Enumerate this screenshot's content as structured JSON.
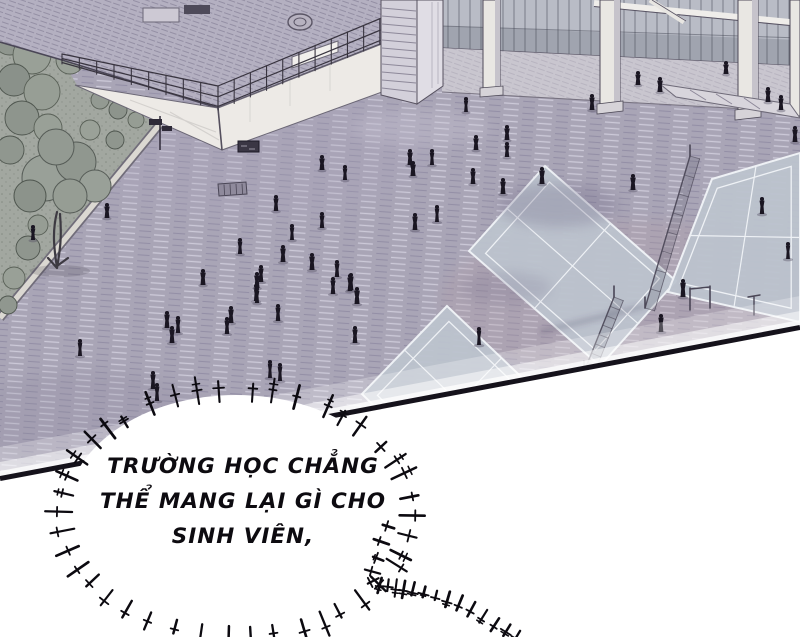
{
  "page": {
    "width": 800,
    "height": 637,
    "background": "#ffffff"
  },
  "panel": {
    "description": "Aerial manga panel: school courtyard with scattered students, badminton courts, glass colonnade, rooftop terrace and garden",
    "border_color": "#15121b"
  },
  "colors": {
    "pavement": "#a9a5b6",
    "court": "#bcc3cd",
    "court_line": "#eef1f5",
    "roof": "#b4b0c1",
    "wall": "#edeae6",
    "garden": "#a2a7a0",
    "foliage": "#959c93",
    "foliage_dark": "#596057",
    "glass": "#b9bcc6",
    "glass_dark": "#8d8f9c",
    "pillar": "#e9e7e3",
    "figure": "#1a1622",
    "figure_shadow": "#565064",
    "net": "#4a4656",
    "bubble_fill": "#ffffff",
    "bubble_stroke": "#0c0a10",
    "text": "#0d0b10"
  },
  "speech_bubble": {
    "lines": [
      "TRƯỜNG HỌC CHẲNG",
      "THỂ MANG LẠI GÌ CHO",
      "SINH VIÊN,"
    ],
    "center_x": 236,
    "center_y": 514,
    "rx": 170,
    "ry": 119
  },
  "scene": {
    "figures": [
      [
        466,
        112,
        15
      ],
      [
        592,
        110,
        16
      ],
      [
        638,
        85,
        14
      ],
      [
        660,
        92,
        15
      ],
      [
        726,
        74,
        13
      ],
      [
        768,
        102,
        15
      ],
      [
        781,
        110,
        15
      ],
      [
        795,
        142,
        16
      ],
      [
        410,
        165,
        16
      ],
      [
        432,
        165,
        16
      ],
      [
        413,
        176,
        15
      ],
      [
        476,
        150,
        15
      ],
      [
        507,
        140,
        15
      ],
      [
        507,
        157,
        15
      ],
      [
        473,
        184,
        16
      ],
      [
        503,
        194,
        16
      ],
      [
        415,
        230,
        17
      ],
      [
        437,
        222,
        17
      ],
      [
        542,
        184,
        17
      ],
      [
        633,
        190,
        16
      ],
      [
        762,
        214,
        17
      ],
      [
        683,
        297,
        18
      ],
      [
        661,
        332,
        18
      ],
      [
        479,
        345,
        18
      ],
      [
        788,
        259,
        17
      ],
      [
        322,
        170,
        15
      ],
      [
        345,
        180,
        15
      ],
      [
        276,
        211,
        16
      ],
      [
        322,
        228,
        16
      ],
      [
        292,
        240,
        16
      ],
      [
        283,
        262,
        17
      ],
      [
        312,
        270,
        17
      ],
      [
        337,
        277,
        17
      ],
      [
        351,
        290,
        17
      ],
      [
        261,
        282,
        17
      ],
      [
        240,
        254,
        16
      ],
      [
        256,
        301,
        17
      ],
      [
        231,
        323,
        17
      ],
      [
        203,
        285,
        16
      ],
      [
        107,
        218,
        15
      ],
      [
        33,
        240,
        15
      ],
      [
        167,
        328,
        17
      ],
      [
        178,
        333,
        17
      ],
      [
        172,
        343,
        17
      ],
      [
        227,
        334,
        17
      ],
      [
        257,
        288,
        16
      ],
      [
        257,
        303,
        16
      ],
      [
        278,
        321,
        17
      ],
      [
        333,
        294,
        17
      ],
      [
        350,
        291,
        17
      ],
      [
        357,
        304,
        17
      ],
      [
        280,
        381,
        18
      ],
      [
        270,
        378,
        18
      ],
      [
        153,
        389,
        18
      ],
      [
        355,
        343,
        17
      ],
      [
        80,
        356,
        17
      ],
      [
        157,
        401,
        18
      ]
    ],
    "courts": [
      {
        "points": [
          [
            545,
            166
          ],
          [
            469,
            251
          ],
          [
            600,
            366
          ],
          [
            676,
            281
          ]
        ]
      },
      {
        "points": [
          [
            712,
            179
          ],
          [
            800,
            153
          ],
          [
            800,
            322
          ],
          [
            668,
            292
          ]
        ]
      },
      {
        "points": [
          [
            447,
            306
          ],
          [
            362,
            394
          ],
          [
            470,
            500
          ],
          [
            556,
            410
          ]
        ]
      }
    ],
    "nets": [
      {
        "x1": 690,
        "y1": 156,
        "x2": 645,
        "y2": 308
      },
      {
        "x1": 614,
        "y1": 297,
        "x2": 584,
        "y2": 372
      }
    ],
    "railings": [
      {
        "x1": 62,
        "t1": 54,
        "x2": 218,
        "t2": 86,
        "h1": 10,
        "h2": 24,
        "posts": 9
      },
      {
        "x1": 218,
        "t1": 86,
        "x2": 396,
        "t2": 12,
        "h1": 24,
        "h2": 26,
        "posts": 11
      }
    ],
    "mullions": {
      "x1": 442,
      "x2": 800,
      "yb1": 48,
      "yb2": 66,
      "step": 11
    },
    "bubble_tail": [
      [
        390,
        527
      ],
      [
        385,
        543
      ],
      [
        379,
        559
      ],
      [
        374,
        572
      ],
      [
        373,
        581
      ],
      [
        380,
        584
      ],
      [
        388,
        585
      ],
      [
        396,
        586
      ],
      [
        404,
        587
      ],
      [
        413,
        589
      ],
      [
        424,
        592
      ],
      [
        436,
        595
      ],
      [
        448,
        598
      ],
      [
        460,
        602
      ],
      [
        472,
        608
      ],
      [
        484,
        615
      ],
      [
        496,
        623
      ],
      [
        507,
        630
      ],
      [
        517,
        636
      ]
    ]
  }
}
